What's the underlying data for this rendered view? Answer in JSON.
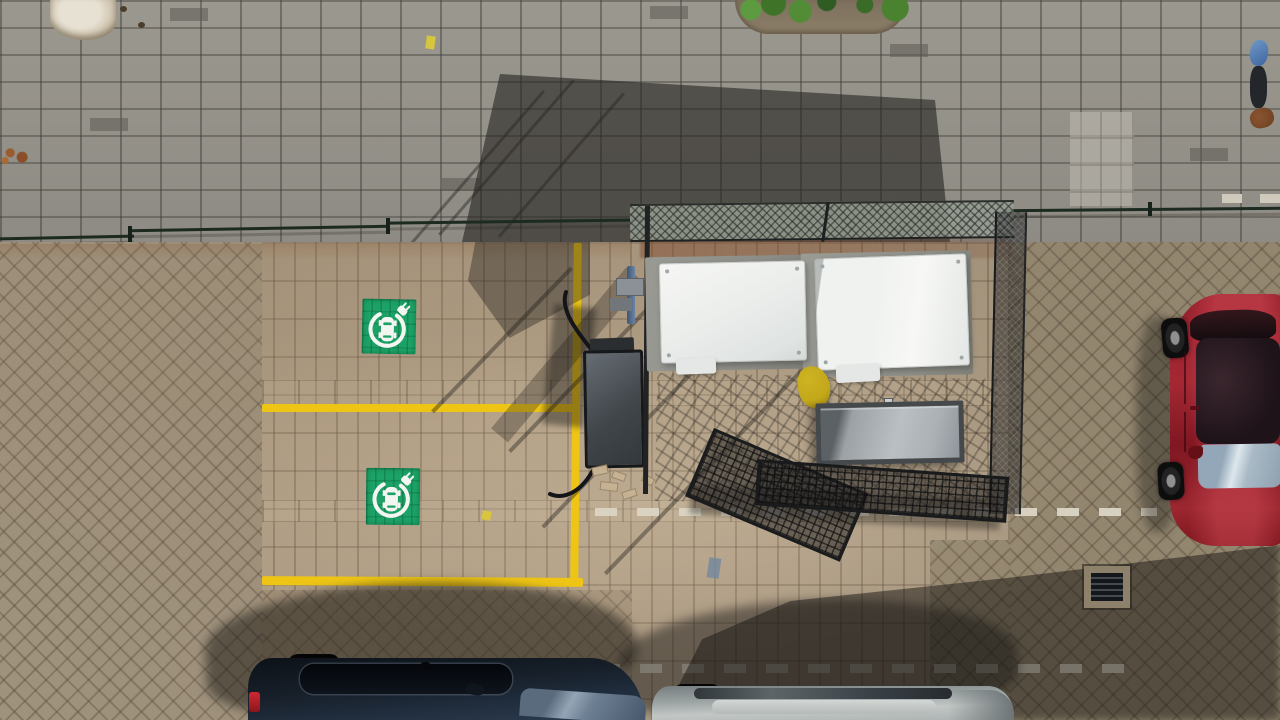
{
  "scene": {
    "type": "aerial-drone-photo",
    "subject": "Top-down view of a parking lot with two EV charging bays marked in yellow, a fenced cage holding white equipment cabinets, and parked cars",
    "lighting": "strong sunlight from lower-right casting long shadows up-left",
    "objects": [
      {
        "name": "ev-charging-sign",
        "count": 2,
        "color_key": "sign_green",
        "icon": "car-in-circle-with-plug"
      },
      {
        "name": "ev-bay-yellow-lines",
        "count": 3,
        "color_key": "yellow_line"
      },
      {
        "name": "mesh-cage-enclosure",
        "count": 1,
        "color_key": "mesh_dark"
      },
      {
        "name": "white-equipment-cabinet",
        "count": 2,
        "color_key": "cabinet_white"
      },
      {
        "name": "concrete-pad",
        "count": 2,
        "color_key": "pad_gray"
      },
      {
        "name": "metal-storage-box",
        "count": 1,
        "color_key": "box_metal_light"
      },
      {
        "name": "yellow-bag",
        "count": 1,
        "color_key": "bag_yellow"
      },
      {
        "name": "charging-station-box",
        "count": 1
      },
      {
        "name": "open-gate-mesh-panel",
        "count": 2
      },
      {
        "name": "red-car",
        "count": 1,
        "color_key": "car_red"
      },
      {
        "name": "dark-blue-car",
        "count": 1,
        "color_key": "car_blue"
      },
      {
        "name": "silver-car",
        "count": 1,
        "color_key": "car_silver"
      },
      {
        "name": "pedestrian",
        "count": 1,
        "color_key": "ped_blue"
      },
      {
        "name": "white-dashed-bay-line",
        "count": 3,
        "color_key": "dash_white"
      },
      {
        "name": "drain-grate",
        "count": 1,
        "color_key": "drain_dark"
      },
      {
        "name": "bush-planter",
        "count": 1,
        "color_key": "bush_green"
      },
      {
        "name": "tree-pit-patch",
        "count": 1
      },
      {
        "name": "green-boundary-fence-rail",
        "count": 4,
        "color_key": "fence_green"
      },
      {
        "name": "brick-debris-pile",
        "count": 1,
        "color_key": "debris_tan"
      }
    ],
    "image_size": {
      "width": 1280,
      "height": 720
    }
  },
  "colors": {
    "sidewalk_base": "#94918a",
    "pavement_base": "#a5947d",
    "herringbone_left": "#9f927d",
    "herringbone_right": "#93866f",
    "shadow_dark": "rgba(36,35,32,0.6)",
    "yellow_line": "#eec515",
    "sign_green": "#1ca266",
    "icon_white": "#f2f5f0",
    "fence_green": "#1c2a20",
    "mesh_light": "#9aa79b",
    "mesh_dark": "#242628",
    "cabinet_white": "#eef0ee",
    "pad_gray": "#90918b",
    "box_metal_light": "#b2b8bc",
    "box_metal_dark": "#3c4043",
    "bag_yellow": "#ceb322",
    "car_red": "#9c222d",
    "car_blue": "#1a2330",
    "car_silver": "#a8aeae",
    "windshield_blue": "#b8c6d2",
    "dash_white": "#dbd5c5",
    "debris_tan": "#c6b193",
    "bush_green": "#4a7c33",
    "drain_dark": "#15181b",
    "ped_blue": "#3d66a0",
    "ped_brown": "#6b3f22",
    "cable_black": "#141519"
  }
}
